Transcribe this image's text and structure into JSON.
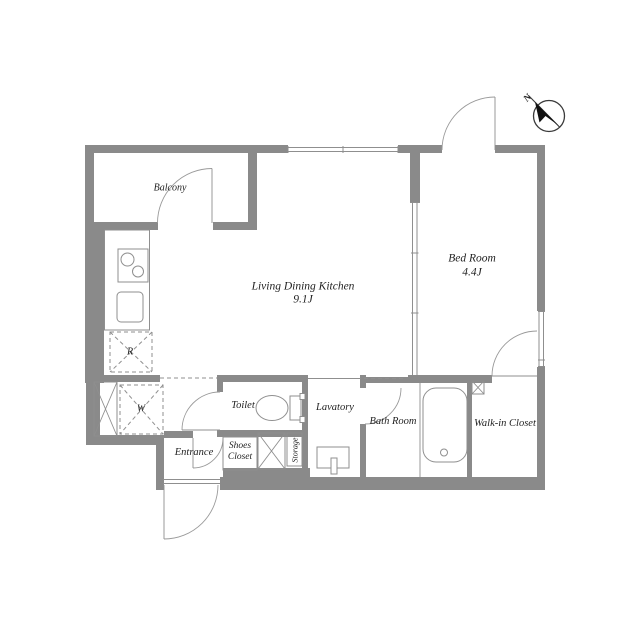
{
  "title": "Apartment floor plan",
  "colors": {
    "wall": "#8a8a8a",
    "line": "#8f8f8f",
    "text": "#1f1f1f",
    "bg": "#ffffff",
    "frame": "#d8d8d8",
    "needle": "#111111"
  },
  "rooms": {
    "balcony": {
      "label": "Balcony"
    },
    "ldk": {
      "label": "Living Dining Kitchen",
      "size": "9.1J"
    },
    "bedroom": {
      "label": "Bed Room",
      "size": "4.4J"
    },
    "toilet": {
      "label": "Toilet"
    },
    "lavatory": {
      "label": "Lavatory"
    },
    "bathroom": {
      "label": "Bath Room"
    },
    "walk_in_closet": {
      "label": "Walk-in Closet"
    },
    "entrance": {
      "label": "Entrance"
    },
    "shoes_closet": {
      "label": "Shoes\nCloset"
    },
    "storage": {
      "label": "Storage"
    }
  },
  "appliances": {
    "refrigerator": "R",
    "washer": "W"
  },
  "compass": {
    "north": "N"
  }
}
